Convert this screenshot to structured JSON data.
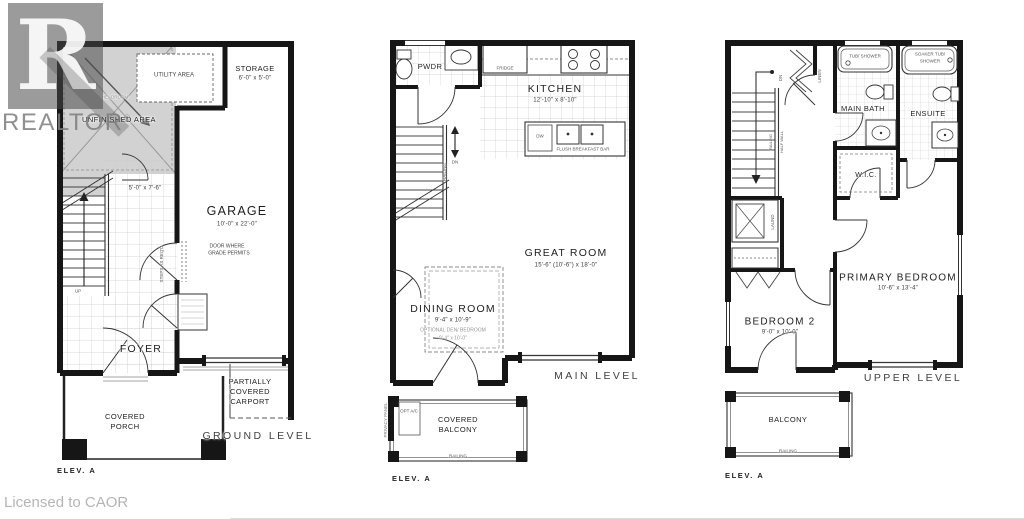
{
  "watermark": {
    "logo_letter": "R",
    "brand": "REALTOR",
    "reg": "®"
  },
  "license_text": "Licensed to CAOR",
  "ground": {
    "level_label": "GROUND LEVEL",
    "elev_label": "ELEV. A",
    "utility_label": "UTILITY AREA",
    "storage_name": "STORAGE",
    "storage_dims": "6'-0\" x 5'-0\"",
    "unfinished_label": "UNFINISHED AREA",
    "headroom_note": "HEADROOM",
    "garage_name": "GARAGE",
    "garage_dims": "10'-0\" x 22'-0\"",
    "stair_dims": "5'-0\" x 7'-6\"",
    "foyer_name": "FOYER",
    "up_label": "UP",
    "door_note_1": "DOOR WHERE",
    "door_note_2": "GRADE PERMITS",
    "steps_note": "STEPS AS REQ'D",
    "porch_1": "COVERED",
    "porch_2": "PORCH",
    "carport_1": "PARTIALLY",
    "carport_2": "COVERED",
    "carport_3": "CARPORT"
  },
  "main": {
    "level_label": "MAIN LEVEL",
    "elev_label": "ELEV. A",
    "pwdr_label": "PWDR",
    "fridge_label": "FRIDGE",
    "kitchen_name": "KITCHEN",
    "kitchen_dims": "12'-10\" x 8'-10\"",
    "dw_label": "DW",
    "breakfast_bar": "FLUSH BREAKFAST BAR",
    "great_room_name": "GREAT ROOM",
    "great_room_dims": "15'-6\" (10'-6\") x 18'-0\"",
    "dining_name": "DINING ROOM",
    "dining_dims": "9'-4\" x 10'-9\"",
    "optional_den": "OPTIONAL DEN/ BEDROOM",
    "optional_den_dims": "9'-4\" x 10'-0\"",
    "dn_label": "DN",
    "stair_railing": "RAILING",
    "balcony_1": "COVERED",
    "balcony_2": "BALCONY",
    "balcony_railing": "RAILING",
    "privacy_panel": "PRIVACY PANEL",
    "opt_ac": "OPT A/C"
  },
  "upper": {
    "level_label": "UPPER LEVEL",
    "elev_label": "ELEV. A",
    "dn_label": "DN",
    "stair_railing": "RAILING",
    "half_wall": "HALF WALL",
    "linen_label": "LINEN",
    "tub_label": "TUB/ SHOWER",
    "soaker_1": "SOAKER TUB/",
    "soaker_2": "SHOWER",
    "main_bath": "MAIN BATH",
    "ensuite": "ENSUITE",
    "wic": "W.I.C.",
    "laundry": "LAUND",
    "bedroom2_name": "BEDROOM 2",
    "bedroom2_dims": "9'-0\" x 10'-0\"",
    "primary_name": "PRIMARY BEDROOM",
    "primary_dims": "10'-6\" x 13'-4\"",
    "balcony_label": "BALCONY",
    "balcony_railing": "RAILING"
  }
}
